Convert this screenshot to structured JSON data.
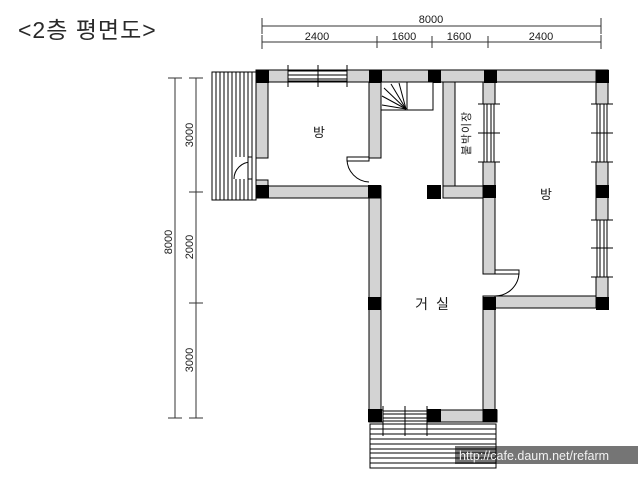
{
  "title": "<2층 평면도>",
  "plan": {
    "rooms": [
      {
        "id": "room-left",
        "label": "방"
      },
      {
        "id": "room-right",
        "label": "방"
      },
      {
        "id": "living-room",
        "label": "거 실"
      },
      {
        "id": "closet",
        "label": "붙박이장"
      }
    ]
  },
  "dimensions": {
    "top": {
      "total": "8000",
      "segments": [
        "2400",
        "1600",
        "1600",
        "2400"
      ]
    },
    "left": {
      "total": "8000",
      "segments": [
        "3000",
        "2000",
        "3000"
      ]
    }
  },
  "watermark": {
    "url_text": "http://cafe.daum.net/refarm"
  },
  "colors": {
    "background": "#ffffff",
    "wall_fill": "#d3d3d3",
    "line": "#000000",
    "column_fill": "#000000",
    "watermark_bg": "#757575",
    "watermark_text": "#f2f2f2"
  }
}
